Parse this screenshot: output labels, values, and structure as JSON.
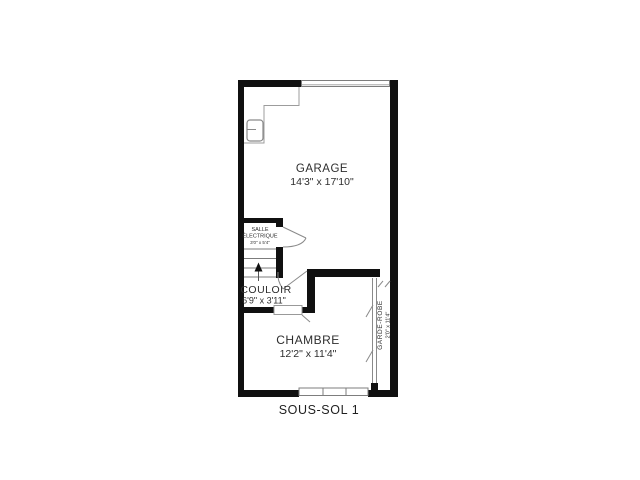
{
  "plan": {
    "title": "SOUS-SOL 1",
    "rooms": {
      "garage": {
        "name": "GARAGE",
        "dims": "14'3\" x 17'10\""
      },
      "salle_electrique": {
        "name_line1": "SALLE",
        "name_line2": "ÉLECTRIQUE",
        "dims": "3'0\" x 5'4\""
      },
      "couloir": {
        "name": "COULOIR",
        "dims": "6'9\" x 3'11\""
      },
      "chambre": {
        "name": "CHAMBRE",
        "dims": "12'2\" x 11'4\""
      },
      "garde_robe": {
        "name": "GARDE-ROBE",
        "dims": "2'0\" x 11'4\""
      }
    },
    "colors": {
      "wall": "#101010",
      "thin_line": "#8a8a8a",
      "text": "#2e2e2e"
    }
  }
}
